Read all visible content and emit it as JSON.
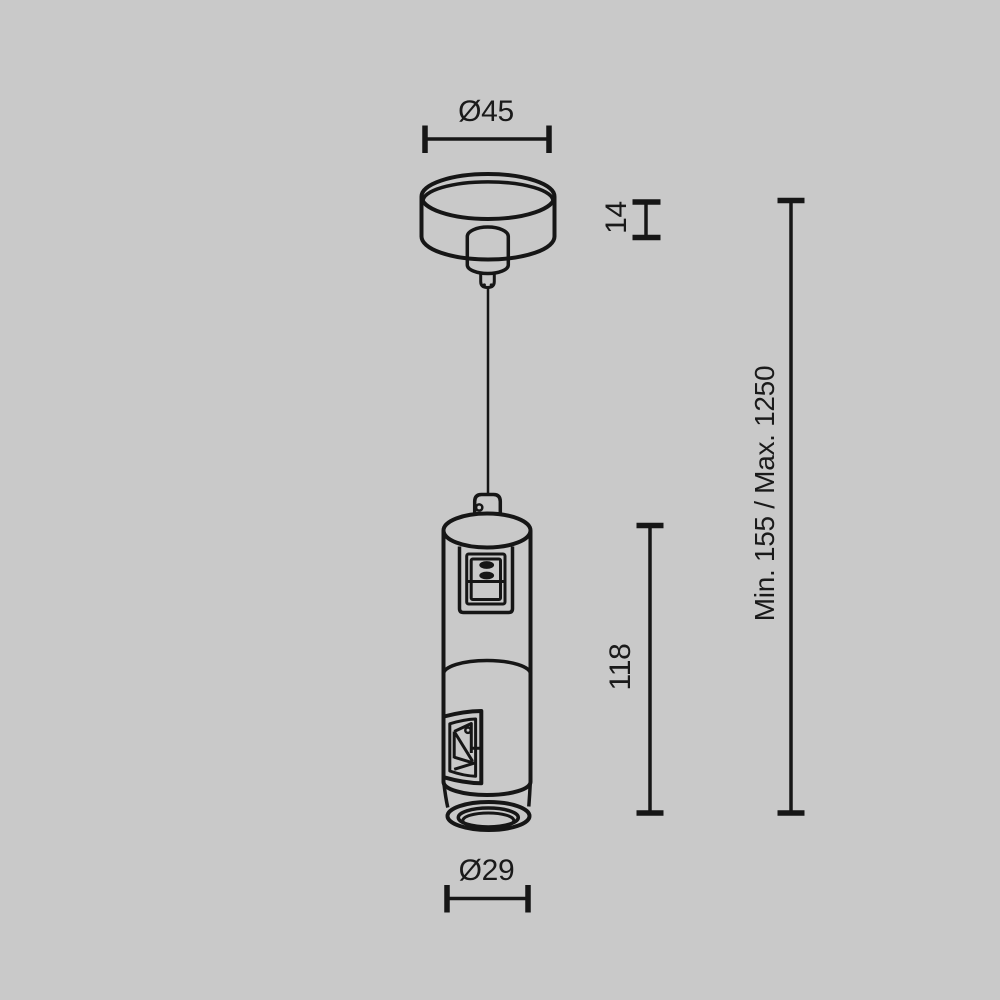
{
  "page": {
    "background_color": "#c9c9c9",
    "line_color": "#161616",
    "text_color": "#1a1a1a"
  },
  "drawing": {
    "type": "technical-dimension-drawing",
    "subject": "pendant suspension kit: ceiling canopy with strain relief, steel suspension cable, cylindrical body with rocker switch, side adjustment window and bottom lens ring"
  },
  "dimensions": {
    "canopy_diameter": {
      "label": "Ø45",
      "value": 45,
      "orientation": "horizontal"
    },
    "canopy_height": {
      "label": "14",
      "value": 14,
      "orientation": "vertical"
    },
    "body_height": {
      "label": "118",
      "value": 118,
      "orientation": "vertical"
    },
    "suspension_range": {
      "label": "Min. 155 / Max. 1250",
      "min": 155,
      "max": 1250,
      "orientation": "vertical"
    },
    "body_diameter": {
      "label": "Ø29",
      "value": 29,
      "orientation": "horizontal"
    }
  }
}
